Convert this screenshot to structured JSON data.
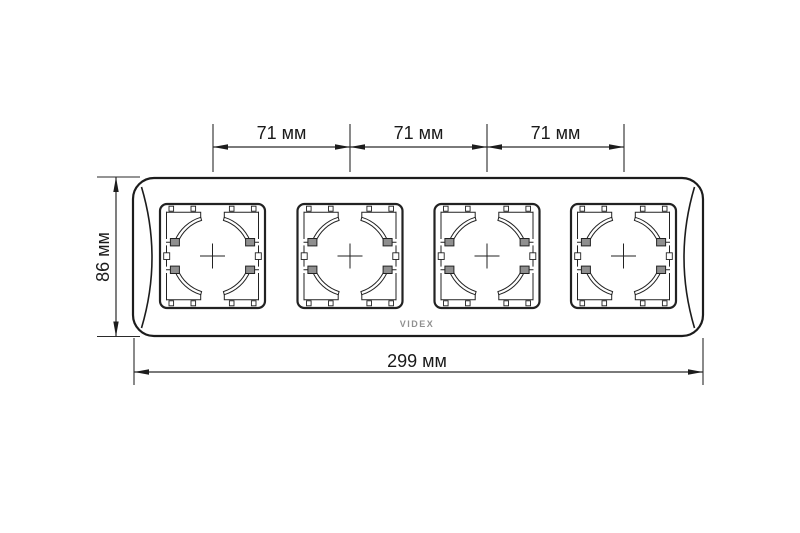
{
  "labels": {
    "dim_top": [
      {
        "label": "71 мм"
      },
      {
        "label": "71 мм"
      },
      {
        "label": "71 мм"
      }
    ],
    "dim_left": {
      "label": "86 мм"
    },
    "dim_bottom": {
      "label": "299 мм"
    },
    "brand": "VIDEX"
  },
  "frame": {
    "window_count": 4
  },
  "colors": {
    "line": "#1c1c1c",
    "dim_line": "#2a2a2a",
    "brand": "#909090",
    "background": "#ffffff"
  }
}
